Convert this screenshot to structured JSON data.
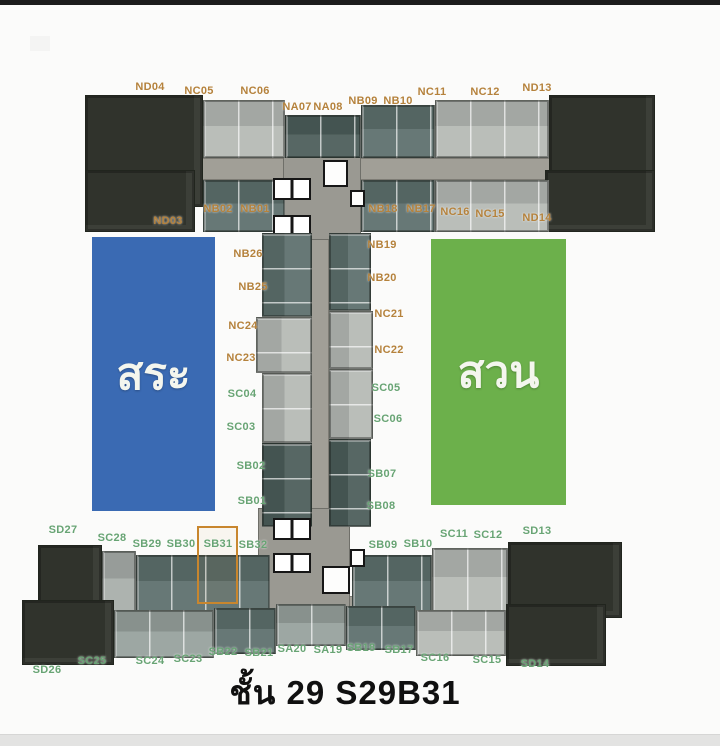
{
  "title": {
    "text": "ชั้น 29 S29B31"
  },
  "areas": {
    "pool": {
      "label": "สระ",
      "color": "#3a6ab3"
    },
    "garden": {
      "label": "สวน",
      "color": "#6cb04b"
    }
  },
  "highlight": {
    "unit": "SB31",
    "border_color": "#c8862e"
  },
  "label_colors": {
    "north_units": "#b5823c",
    "south_units": "#68a474"
  },
  "units": [
    {
      "id": "ND04",
      "x": 150,
      "y": 87
    },
    {
      "id": "NC05",
      "x": 199,
      "y": 91
    },
    {
      "id": "NC06",
      "x": 255,
      "y": 91
    },
    {
      "id": "NA07",
      "x": 297,
      "y": 107
    },
    {
      "id": "NA08",
      "x": 328,
      "y": 107
    },
    {
      "id": "NB09",
      "x": 363,
      "y": 101
    },
    {
      "id": "NB10",
      "x": 398,
      "y": 101
    },
    {
      "id": "NC11",
      "x": 432,
      "y": 92
    },
    {
      "id": "NC12",
      "x": 485,
      "y": 92
    },
    {
      "id": "ND13",
      "x": 537,
      "y": 88
    },
    {
      "id": "ND03",
      "x": 168,
      "y": 221
    },
    {
      "id": "NB02",
      "x": 218,
      "y": 209
    },
    {
      "id": "NB01",
      "x": 255,
      "y": 209
    },
    {
      "id": "NB18",
      "x": 383,
      "y": 209
    },
    {
      "id": "NB17",
      "x": 421,
      "y": 209
    },
    {
      "id": "NC16",
      "x": 455,
      "y": 212
    },
    {
      "id": "NC15",
      "x": 490,
      "y": 214
    },
    {
      "id": "ND14",
      "x": 537,
      "y": 218
    },
    {
      "id": "NB26",
      "x": 248,
      "y": 254
    },
    {
      "id": "NB25",
      "x": 253,
      "y": 287
    },
    {
      "id": "NC24",
      "x": 243,
      "y": 326
    },
    {
      "id": "NC23",
      "x": 241,
      "y": 358
    },
    {
      "id": "SC04",
      "x": 242,
      "y": 394
    },
    {
      "id": "SC03",
      "x": 241,
      "y": 427
    },
    {
      "id": "SB02",
      "x": 251,
      "y": 466
    },
    {
      "id": "SB01",
      "x": 252,
      "y": 501
    },
    {
      "id": "NB19",
      "x": 382,
      "y": 245
    },
    {
      "id": "NB20",
      "x": 382,
      "y": 278
    },
    {
      "id": "NC21",
      "x": 389,
      "y": 314
    },
    {
      "id": "NC22",
      "x": 389,
      "y": 350
    },
    {
      "id": "SC05",
      "x": 386,
      "y": 388
    },
    {
      "id": "SC06",
      "x": 388,
      "y": 419
    },
    {
      "id": "SB07",
      "x": 382,
      "y": 474
    },
    {
      "id": "SB08",
      "x": 381,
      "y": 506
    },
    {
      "id": "SD27",
      "x": 63,
      "y": 530
    },
    {
      "id": "SC28",
      "x": 112,
      "y": 538
    },
    {
      "id": "SB29",
      "x": 147,
      "y": 544
    },
    {
      "id": "SB30",
      "x": 181,
      "y": 544
    },
    {
      "id": "SB31",
      "x": 218,
      "y": 544
    },
    {
      "id": "SB32",
      "x": 253,
      "y": 545
    },
    {
      "id": "SB09",
      "x": 383,
      "y": 545
    },
    {
      "id": "SB10",
      "x": 418,
      "y": 544
    },
    {
      "id": "SC11",
      "x": 454,
      "y": 534
    },
    {
      "id": "SC12",
      "x": 488,
      "y": 535
    },
    {
      "id": "SD13",
      "x": 537,
      "y": 531
    },
    {
      "id": "SD26",
      "x": 47,
      "y": 670
    },
    {
      "id": "SC25",
      "x": 92,
      "y": 661
    },
    {
      "id": "SC24",
      "x": 150,
      "y": 661
    },
    {
      "id": "SC23",
      "x": 188,
      "y": 659
    },
    {
      "id": "SB22",
      "x": 223,
      "y": 652
    },
    {
      "id": "SB21",
      "x": 259,
      "y": 653
    },
    {
      "id": "SA20",
      "x": 292,
      "y": 649
    },
    {
      "id": "SA19",
      "x": 328,
      "y": 650
    },
    {
      "id": "SB18",
      "x": 361,
      "y": 648
    },
    {
      "id": "SB17",
      "x": 399,
      "y": 650
    },
    {
      "id": "SC16",
      "x": 435,
      "y": 658
    },
    {
      "id": "SC15",
      "x": 487,
      "y": 660
    },
    {
      "id": "SD14",
      "x": 535,
      "y": 664
    }
  ]
}
